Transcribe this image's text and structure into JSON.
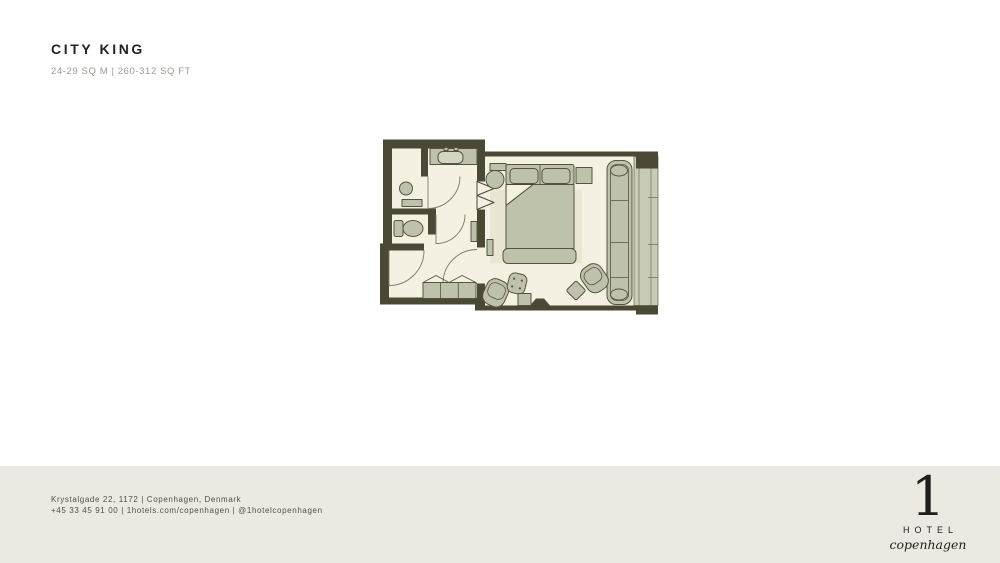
{
  "colors": {
    "page-bg": "#ffffff",
    "footer-bg": "#ebe9e1",
    "title-color": "#232323",
    "subtitle-color": "#9b9a92",
    "footer-text-color": "#50504a",
    "logo-color": "#1e1e1c",
    "wall": "#4a4936",
    "floor": "#f4f1e2",
    "furniture": "#bec2aa",
    "furniture-stroke": "#565441",
    "rug": "#e9e6d3",
    "window-glass": "#c8cbb6",
    "window-frame": "#72715c",
    "door-arc": "#7b7a64",
    "sink": "#d3d5c3"
  },
  "header": {
    "title": "CITY KING",
    "subtitle": "24-29 SQ M | 260-312 SQ FT"
  },
  "floorplan": {
    "name": "City King room floor plan",
    "furniture": [
      "vanity-sink",
      "stool",
      "wall-bench",
      "toilet",
      "closet",
      "king-bed",
      "pillows",
      "headboard",
      "bed-bench",
      "nightstand",
      "console",
      "side-table",
      "rug",
      "sofa",
      "armchair",
      "ottoman",
      "lounge-chair",
      "pouf",
      "coffee-table",
      "window-wall"
    ]
  },
  "footer": {
    "address": "Krystalgade 22, 1172 | Copenhagen, Denmark",
    "contact": "+45 33 45 91 00 | 1hotels.com/copenhagen | @1hotelcopenhagen",
    "logo": {
      "numeral": "1",
      "name": "HOTEL",
      "city": "copenhagen"
    }
  }
}
